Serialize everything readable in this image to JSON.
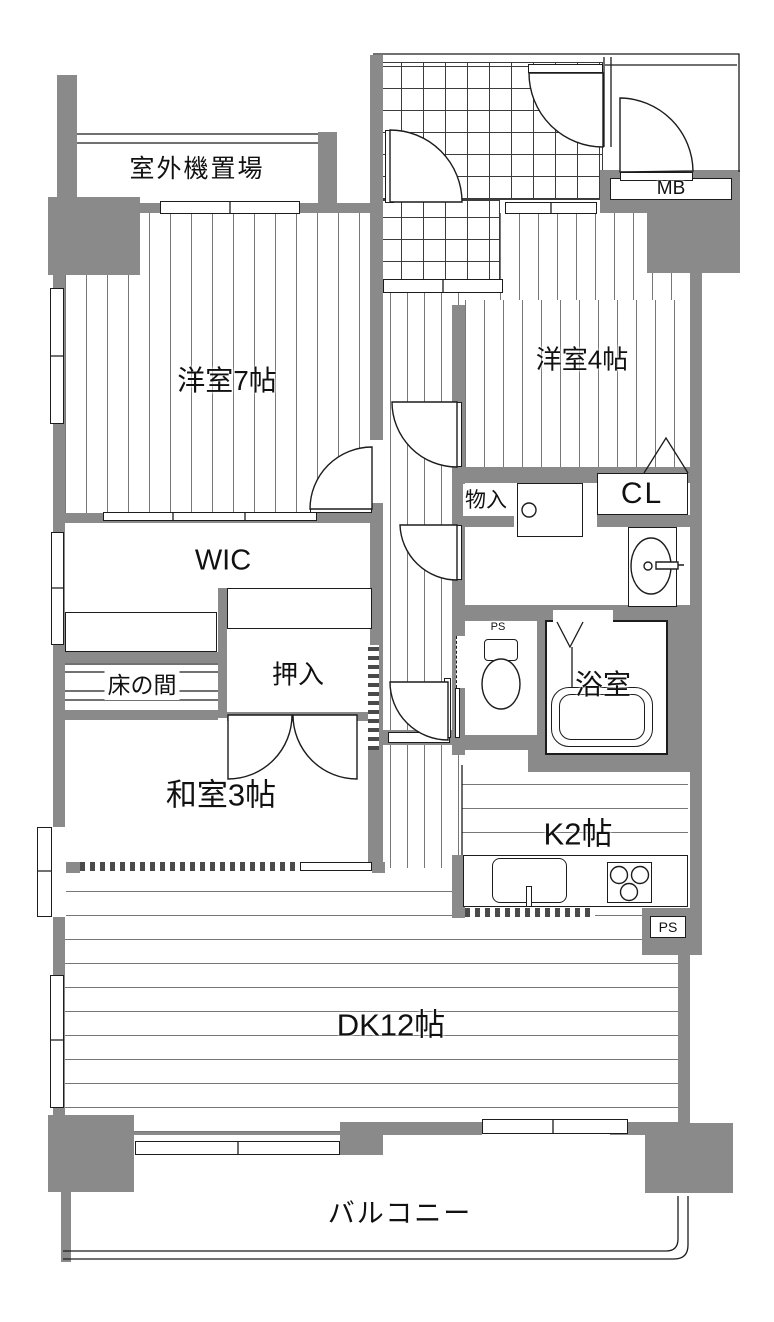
{
  "colors": {
    "wall": "#8a8a8a",
    "line": "#1c1c1c",
    "floor_line": "#777777",
    "tile_line": "#3c3c3c"
  },
  "rooms": {
    "outdoor_unit": {
      "label": "室外機置場"
    },
    "bedroom7": {
      "label": "洋室7帖"
    },
    "bedroom4": {
      "label": "洋室4帖"
    },
    "wic": {
      "label": "WIC"
    },
    "tokonoma": {
      "label": "床の間"
    },
    "oshiire": {
      "label": "押入"
    },
    "washitsu": {
      "label": "和室3帖"
    },
    "storage": {
      "label": "物入"
    },
    "closet": {
      "label": "CL"
    },
    "bathroom": {
      "label": "浴室"
    },
    "kitchen": {
      "label": "K2帖"
    },
    "dining_kitchen": {
      "label": "DK12帖"
    },
    "balcony": {
      "label": "バルコニー"
    },
    "meter_box": {
      "label": "MB"
    },
    "pipe_space_toilet": {
      "label": "PS"
    },
    "pipe_space_kitchen": {
      "label": "PS"
    }
  }
}
